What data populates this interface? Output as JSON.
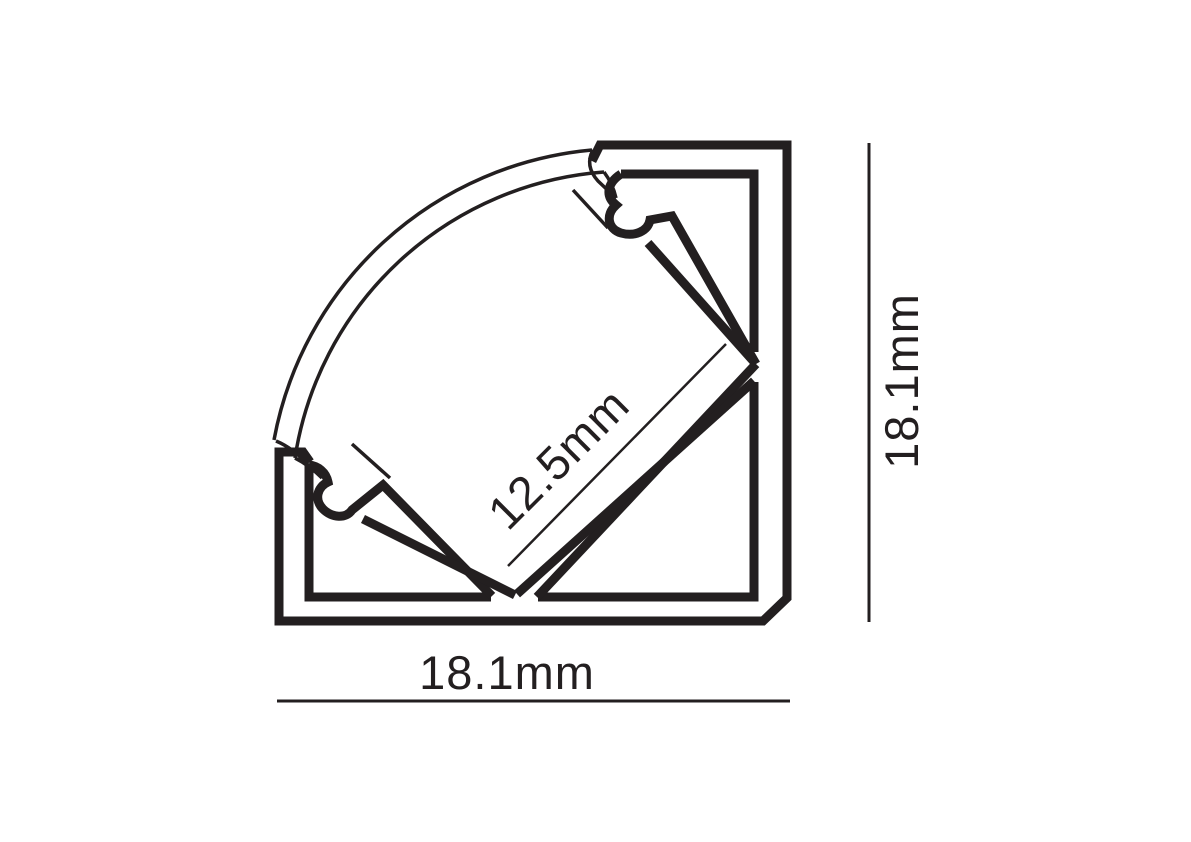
{
  "drawing": {
    "title": "45-degree corner LED profile cross-section",
    "line_color": "#231f20",
    "background_color": "#ffffff",
    "dimensions": {
      "width": {
        "label": "18.1mm"
      },
      "height": {
        "label": "18.1mm"
      },
      "inner_surface": {
        "label": "12.5mm"
      }
    }
  }
}
